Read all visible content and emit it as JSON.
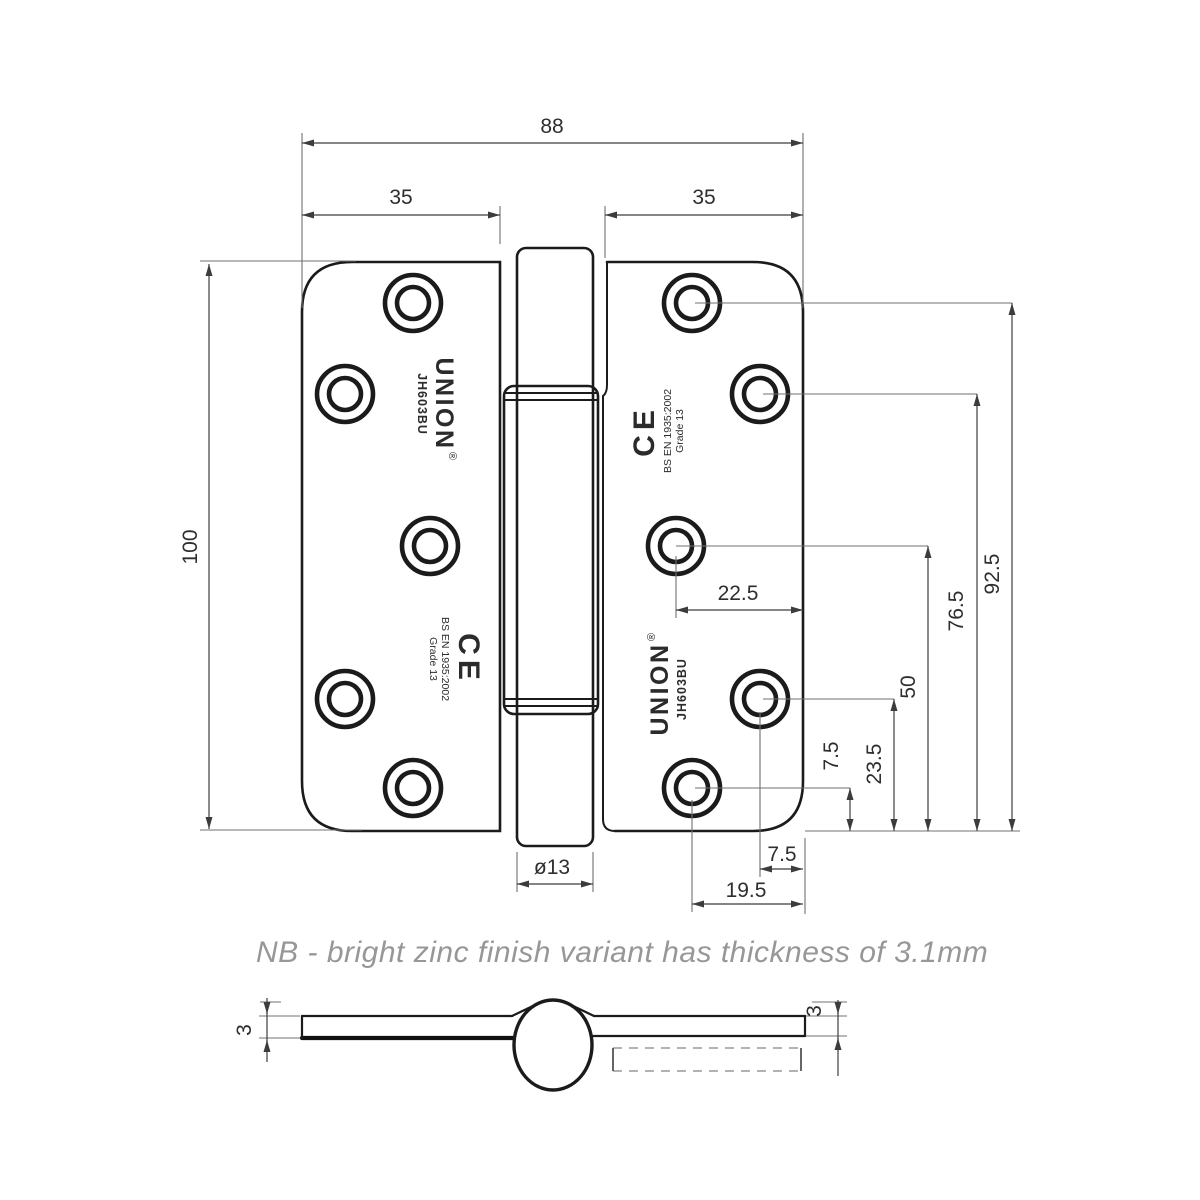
{
  "note": "NB - bright zinc finish variant has thickness of 3.1mm",
  "dimensions": {
    "width_overall": "88",
    "leaf_left": "35",
    "leaf_right": "35",
    "height": "100",
    "knuckle_diameter": "ø13",
    "hole_inset_middle": "22.5",
    "hole_height_1": "92.5",
    "hole_height_2": "76.5",
    "hole_height_3": "50",
    "hole_height_4": "23.5",
    "hole_height_5": "7.5",
    "hole_inset_edge": "7.5",
    "hole_inset_corner": "19.5",
    "thickness_left": "3",
    "thickness_right": "3"
  },
  "markings": {
    "brand": "UNION",
    "model": "JH603BU",
    "registered": "®",
    "ce_mark": "CE",
    "standard": "BS EN 1935:2002",
    "grade": "Grade 13"
  }
}
